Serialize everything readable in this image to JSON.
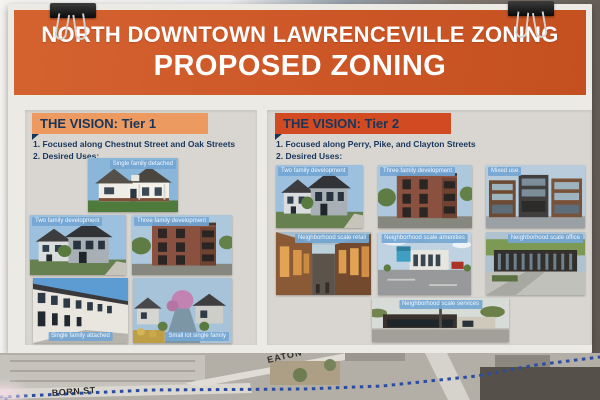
{
  "colors": {
    "banner_orange": "#CD5627",
    "tier1_bar_orange": "#EC9A60",
    "tier2_bar_orange": "#D14A22",
    "navy_text": "#17365C",
    "photo_label_blue": "#74A6D2",
    "map_boundary_blue": "#2A4DA0"
  },
  "banner": {
    "title_line1": "NORTH DOWNTOWN LAWRENCEVILLE ZONING",
    "title_line2": "PROPOSED ZONING"
  },
  "tier1": {
    "header": "THE VISION: Tier 1",
    "bullet1": "1. Focused along Chestnut Street and Oak Streets",
    "bullet2": "2. Desired Uses:",
    "photos": [
      {
        "label": "Single family detached"
      },
      {
        "label": "Two family development"
      },
      {
        "label": "Three family development"
      },
      {
        "label": "Single family attached"
      },
      {
        "label": "Small lot single family"
      }
    ]
  },
  "tier2": {
    "header": "THE VISION: Tier 2",
    "bullet1": "1. Focused along Perry, Pike, and Clayton Streets",
    "bullet2": "2. Desired Uses:",
    "photos": [
      {
        "label": "Two family development"
      },
      {
        "label": "Three family development"
      },
      {
        "label": "Mixed use"
      },
      {
        "label": "Neighborhood scale retail"
      },
      {
        "label": "Neighborhood scale amenities"
      },
      {
        "label": "Neighborhood scale office"
      },
      {
        "label": "Neighborhood scale services"
      }
    ]
  },
  "map": {
    "street_label_1": "EATON",
    "street_label_2": "BORN ST"
  }
}
